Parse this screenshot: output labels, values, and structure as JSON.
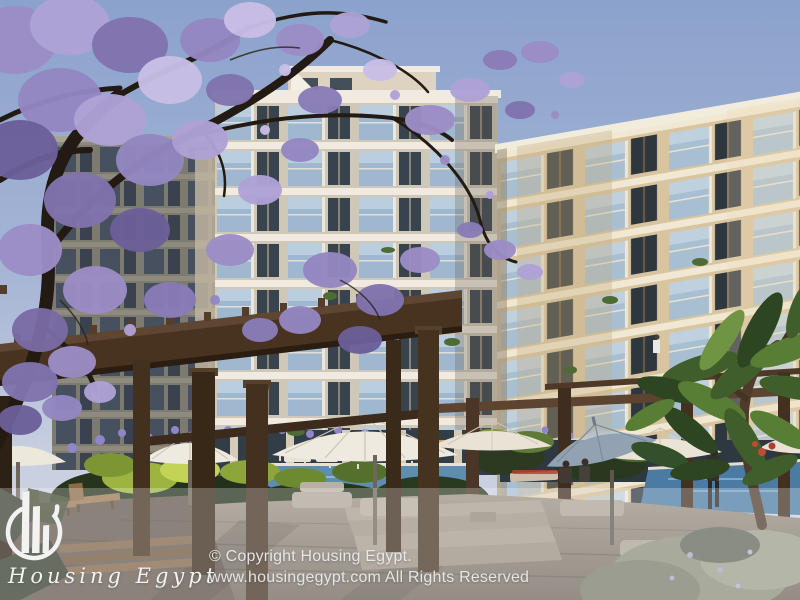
{
  "image": {
    "width": 800,
    "height": 600,
    "kind": "architectural-render-photograph",
    "subject": "Residential apartment compound at dusk with jacaranda tree, wooden pergolas, pool terrace, lounge umbrellas and people"
  },
  "watermark": {
    "brand_name": "Housing Egypt",
    "logo_icon": "buildings-in-circle-icon",
    "copyright_line1": "© Copyright Housing Egypt.",
    "copyright_line2": "www.housingegypt.com All Rights Reserved"
  },
  "colors": {
    "sky_top": "#8BA2CC",
    "sky_mid": "#A6B5D5",
    "sky_horizon": "#C9D0E0",
    "left_facade": "#CFC8B8",
    "left_slab": "#F0EAE0",
    "left_glass": "#9FB8D0",
    "left_window": "#39434E",
    "right_facade": "#D8C5A0",
    "right_slab": "#F1E8D3",
    "right_window": "#2F373E",
    "right_panel": "#C3AB82",
    "blossom_light": "#C9BEE6",
    "blossom_mid": "#9C8DC6",
    "blossom_dark": "#6C5F99",
    "pergola_wood": "#47331F",
    "umbrella_canopy": "#EFEAE0",
    "umbrella_blue": "#93A2B2",
    "pool_water": "#5E8DB0",
    "foliage_dark": "#26331D",
    "foliage_light": "#9DB440",
    "deck": "#8A8174",
    "overlay_band": "rgba(255,255,255,0.26)",
    "watermark_text": "#F2F2F2",
    "copyright_text": "rgba(238,238,238,0.92)"
  }
}
